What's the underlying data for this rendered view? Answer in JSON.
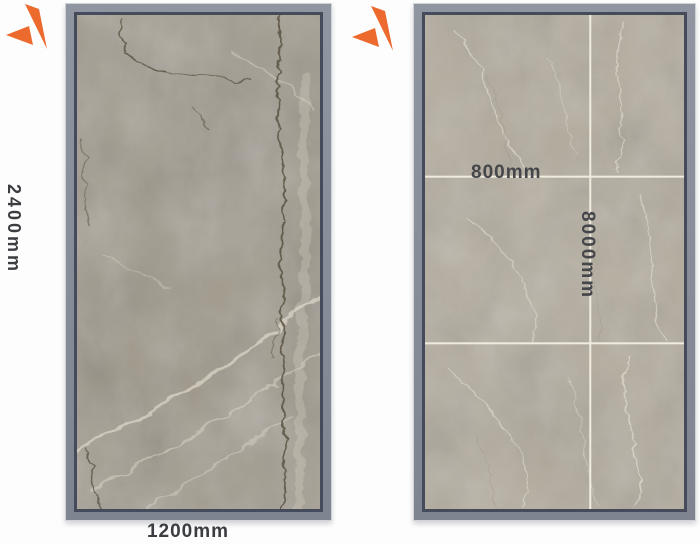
{
  "panels": {
    "left": {
      "description": "full marble slab",
      "height_label": "2400mm",
      "width_label": "1200mm"
    },
    "right": {
      "description": "marble tile grid panel",
      "tile_width_label": "800mm",
      "tile_height_label": "8000mm"
    }
  },
  "icons": {
    "left_mark": "spark-mark",
    "right_mark": "spark-mark"
  },
  "colors": {
    "accent_orange": "#ec6a2e",
    "frame_outer_gray": "#878d98",
    "frame_inner_slate": "#454b5a",
    "grout_line": "#f0ecdf",
    "label_text": "#3b3d40",
    "marble_left_base": "#9d9687",
    "marble_right_base": "#b2aa9b",
    "page_background": "#fdfdfd"
  }
}
